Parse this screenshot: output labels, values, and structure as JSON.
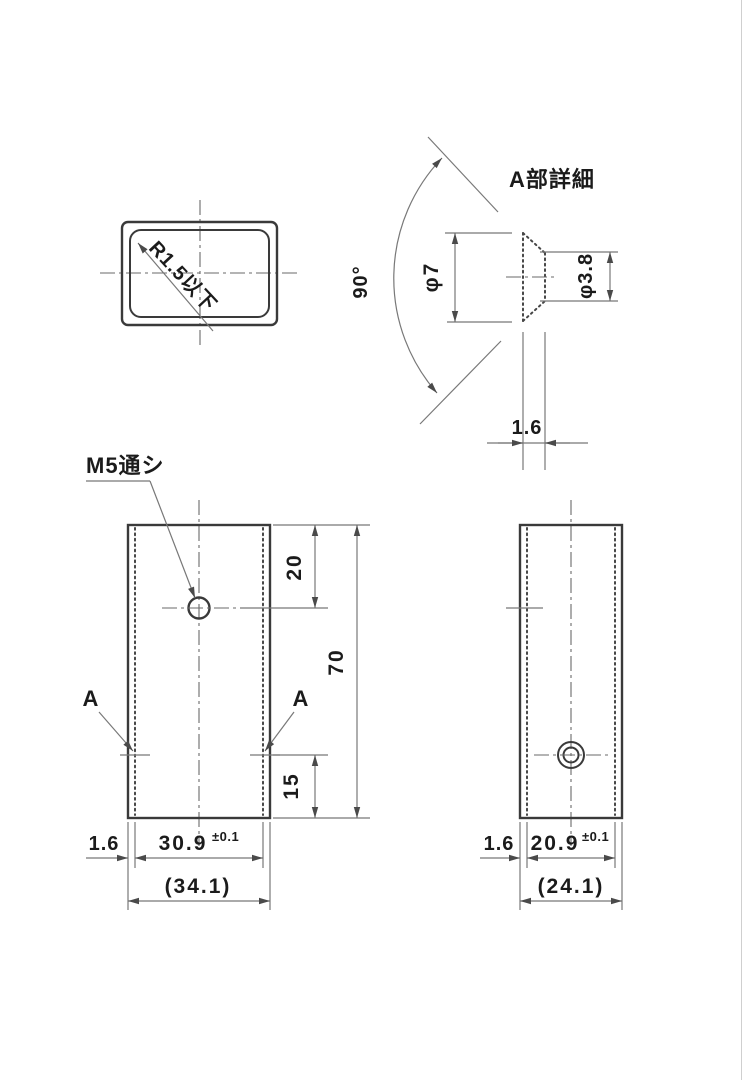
{
  "colors": {
    "background": "#ffffff",
    "object_line": "#3a3a3a",
    "thin_line": "#787878",
    "text": "#1b1b1b"
  },
  "cross_section_view": {
    "radius_note": "R1.5以下"
  },
  "detail_view": {
    "title": "A部詳細",
    "countersink_angle": "90°",
    "outer_diameter": "φ7",
    "hole_diameter": "φ3.8",
    "wall_thickness": "1.6"
  },
  "front_view": {
    "thread_note": "M5通シ",
    "detail_marker_left": "A",
    "detail_marker_right": "A",
    "dim_top_to_hole": "20",
    "dim_overall_height": "70",
    "dim_bottom_to_hole": "15",
    "dim_wall_thickness": "1.6",
    "dim_inner_width": "30.9",
    "dim_inner_width_tolerance": "±0.1",
    "dim_outer_width_ref": "(34.1)"
  },
  "side_view": {
    "dim_wall_thickness": "1.6",
    "dim_inner_depth": "20.9",
    "dim_inner_depth_tolerance": "±0.1",
    "dim_outer_depth_ref": "(24.1)"
  }
}
